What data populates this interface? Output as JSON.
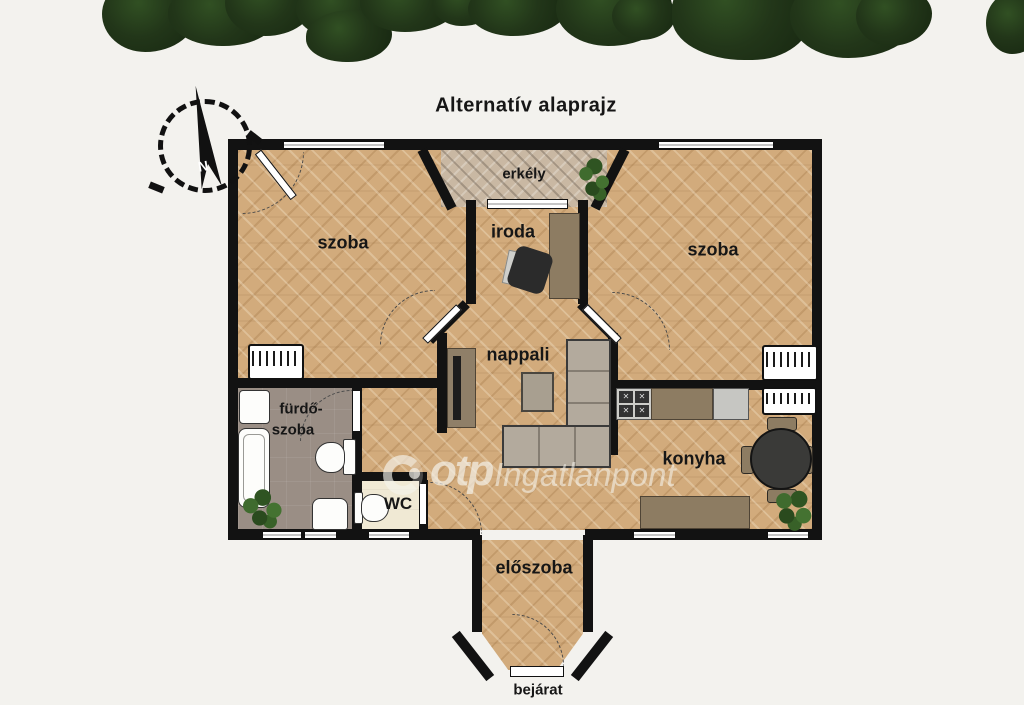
{
  "title": "Alternatív alaprajz",
  "compass": {
    "north": "N"
  },
  "labels": {
    "balcony": "erkély",
    "room_left": "szoba",
    "office": "iroda",
    "room_right": "szoba",
    "living_room": "nappali",
    "bathroom_line1": "fürdő-",
    "bathroom_line2": "szoba",
    "wc": "WC",
    "kitchen": "konyha",
    "hallway": "előszoba",
    "entrance": "bejárat"
  },
  "watermark": {
    "brand": "otp",
    "name": "Ingatlanpont"
  },
  "colors": {
    "background": "#f3f2ee",
    "wall": "#121212",
    "wood_floor": "#d2ab7c",
    "balcony_floor": "#c9b8a3",
    "bathroom_floor": "#9a8e85",
    "wc_floor": "#f0e9d4",
    "tree_green": "#223619",
    "label_text": "#161616"
  }
}
